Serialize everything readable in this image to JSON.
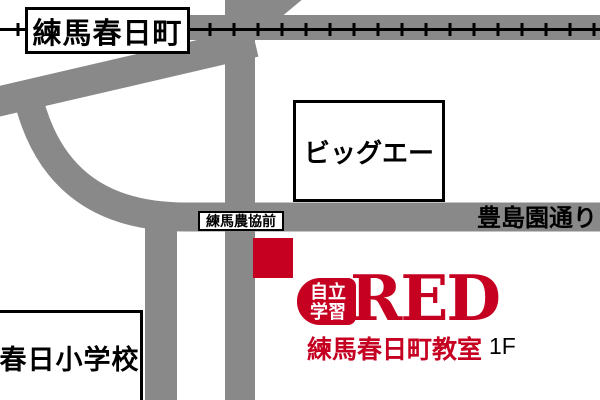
{
  "station": {
    "name": "練馬春日町"
  },
  "railway": {
    "icon": "ticked-rail-line"
  },
  "landmarks": {
    "big_a": "ビッグエー",
    "elementary_school": "春日小学校"
  },
  "bus_stop": {
    "name": "練馬農協前"
  },
  "street": {
    "name": "豊島園通り"
  },
  "destination": {
    "badge_top": "自立",
    "badge_bottom": "学習",
    "brand": "RED",
    "classroom_name": "練馬春日町教室",
    "floor": "1F"
  },
  "marker": {
    "icon": "red-square-location-marker"
  },
  "colors": {
    "road": "#898989",
    "rail": "#000000",
    "brand_red": "#c50020",
    "marker_red": "#c50020",
    "text": "#000000",
    "box_bg": "#ffffff",
    "box_border": "#000000"
  }
}
